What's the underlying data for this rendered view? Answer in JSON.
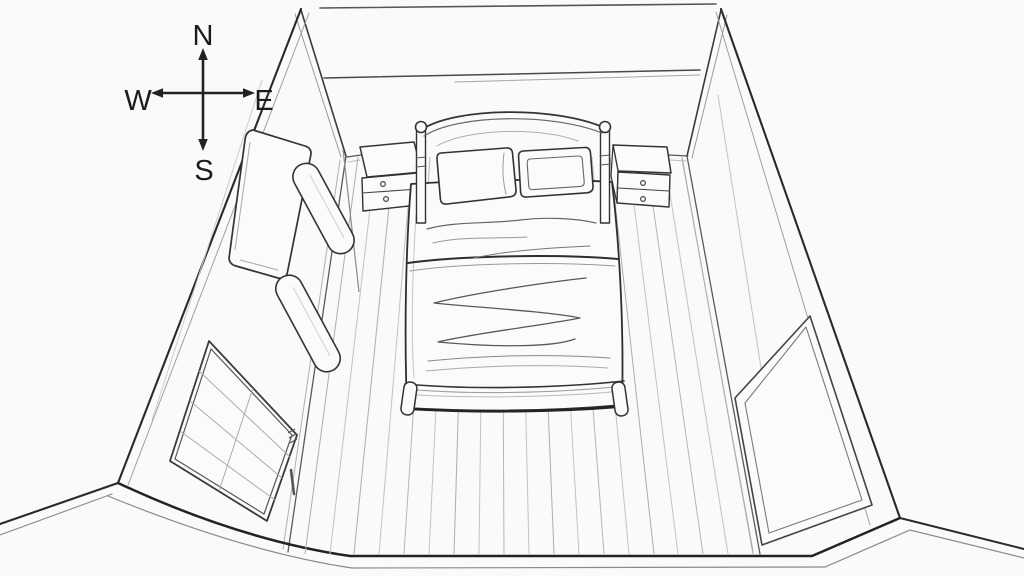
{
  "scene": {
    "description": "Black-and-white line drawing of a bedroom seen from above in wide-angle perspective, open at the front (south) side",
    "background_color": "#fafafa",
    "ink_color": "#2a2a2a",
    "objects": [
      "compass rose",
      "double bed with arched headboard, two posts and two pillows",
      "left nightstand with two drawers and round knobs",
      "right nightstand with two drawers and round knobs",
      "wardrobe with rounded panels against the west wall",
      "four-pane window with latch and handle on the west wall",
      "door panel on the east wall",
      "wood plank floor"
    ]
  },
  "compass": {
    "north": "N",
    "south": "S",
    "east": "E",
    "west": "W",
    "color": "#1c1c1c"
  }
}
